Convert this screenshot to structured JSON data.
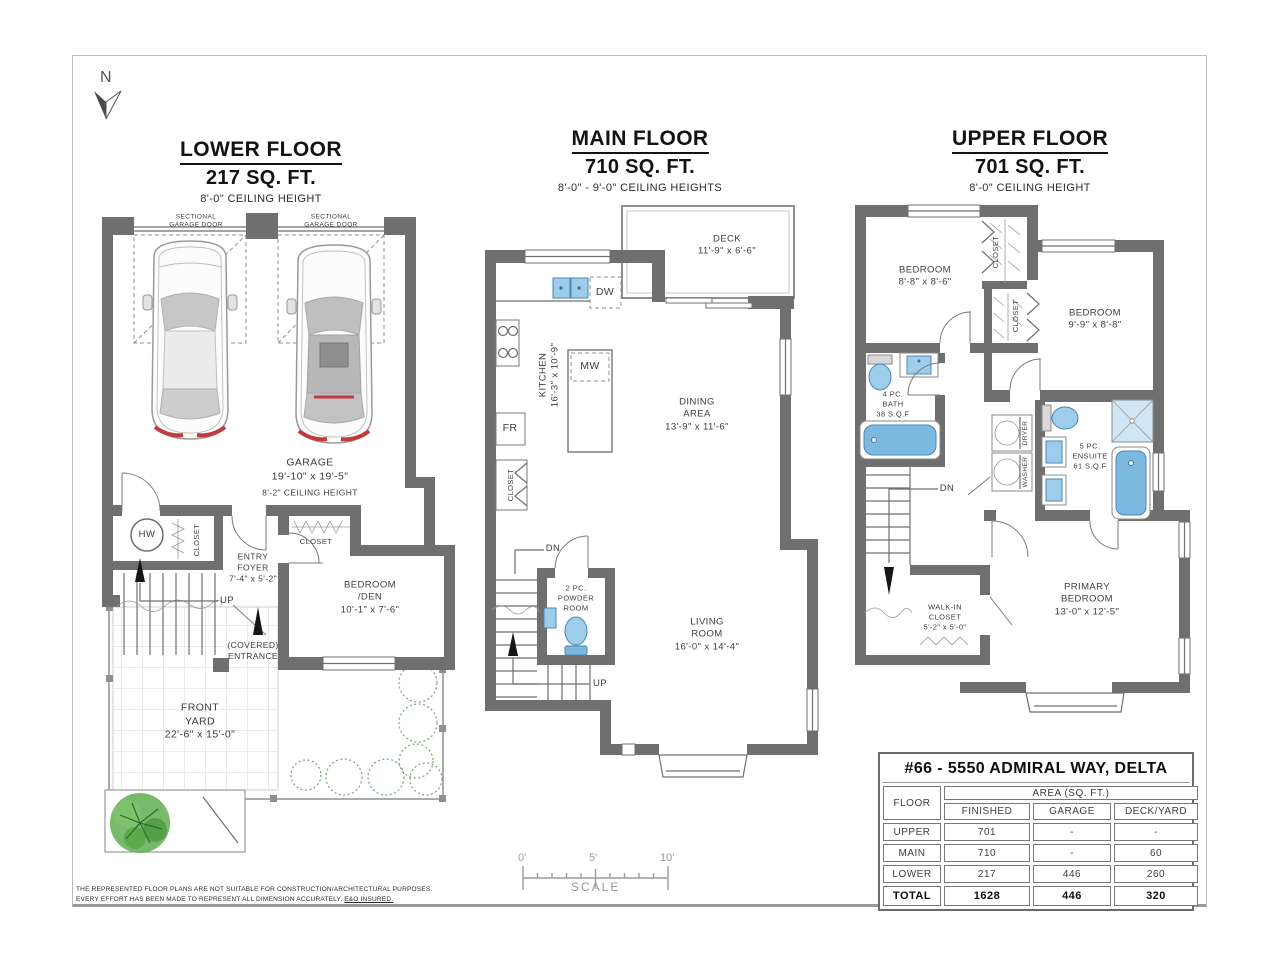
{
  "page": {
    "north": "N",
    "disclaimer1": "THE REPRESENTED FLOOR PLANS ARE NOT SUITABLE FOR CONSTRUCTION/ARCHITECTURAL PURPOSES.",
    "disclaimer2a": "EVERY EFFORT HAS BEEN MADE TO REPRESENT ALL DIMENSION ACCURATELY, ",
    "disclaimer2b": "E&O INSURED."
  },
  "colors": {
    "wall_gray": "#6f6f6f",
    "fixture_blue": "#9ecdeb",
    "tree_green": "#5cab4e",
    "scale_gray": "#9a9a9a",
    "taillight_red": "#c03c3c"
  },
  "floors": {
    "lower": {
      "title": "LOWER FLOOR",
      "area": "217 SQ. FT.",
      "ceiling": "8'-0\" CEILING HEIGHT",
      "labels": {
        "sect_door_l": "SECTIONAL\nGARAGE DOOR",
        "sect_door_r": "SECTIONAL\nGARAGE DOOR",
        "garage": "GARAGE\n19'-10\" x 19'-5\"",
        "garage_ceiling": "8'-2\" CEILING HEIGHT",
        "hw": "HW",
        "closet_foyer": "CLOSET",
        "entry_foyer": "ENTRY\nFOYER\n7'-4\" x 5'-2\"",
        "up": "UP",
        "closet_bedroom": "CLOSET",
        "bedroom_den": "BEDROOM\n/DEN\n10'-1\" x 7'-6\"",
        "covered_entrance": "(COVERED)\nENTRANCE",
        "front_yard": "FRONT\nYARD\n22'-6\" x 15'-0\""
      }
    },
    "main": {
      "title": "MAIN FLOOR",
      "area": "710 SQ. FT.",
      "ceiling": "8'-0\" - 9'-0\" CEILING HEIGHTS",
      "labels": {
        "deck": "DECK\n11'-9\" x 6'-6\"",
        "dw": "DW",
        "kitchen": "KITCHEN\n16'-3\" x 10'-9\"",
        "mw": "MW",
        "fr": "FR",
        "closet": "CLOSET",
        "dining": "DINING\nAREA\n13'-9\" x 11'-6\"",
        "dn": "DN",
        "powder": "2 PC.\nPOWDER\nROOM",
        "up": "UP",
        "living": "LIVING\nROOM\n16'-0\" x 14'-4\""
      }
    },
    "upper": {
      "title": "UPPER FLOOR",
      "area": "701 SQ. FT.",
      "ceiling": "8'-0\" CEILING HEIGHT",
      "labels": {
        "bedroom1": "BEDROOM\n8'-8\" x 8'-6\"",
        "closet1": "CLOSET",
        "closet2": "CLOSET",
        "bedroom2": "BEDROOM\n9'-9\" x 8'-8\"",
        "bath": "4 PC.\nBATH\n38 S.Q.F",
        "dryer": "DRYER",
        "washer": "WASHER",
        "ensuite": "5 PC.\nENSUITE\n61 S.Q.F",
        "dn": "DN",
        "walkin": "WALK-IN\nCLOSET\n5'-2\" x 5'-0\"",
        "primary": "PRIMARY\nBEDROOM\n13'-0\" x 12'-5\""
      }
    }
  },
  "scale_bar": {
    "t0": "0'",
    "t5": "5'",
    "t10": "10'",
    "label": "SCALE"
  },
  "table": {
    "title": "#66 - 5550 ADMIRAL WAY, DELTA",
    "floor_col": "FLOOR",
    "area_group": "AREA (SQ. FT.)",
    "cols": [
      "FINISHED",
      "GARAGE",
      "DECK/YARD"
    ],
    "rows": [
      [
        "UPPER",
        "701",
        "-",
        "-"
      ],
      [
        "MAIN",
        "710",
        "-",
        "60"
      ],
      [
        "LOWER",
        "217",
        "446",
        "260"
      ],
      [
        "TOTAL",
        "1628",
        "446",
        "320"
      ]
    ]
  }
}
